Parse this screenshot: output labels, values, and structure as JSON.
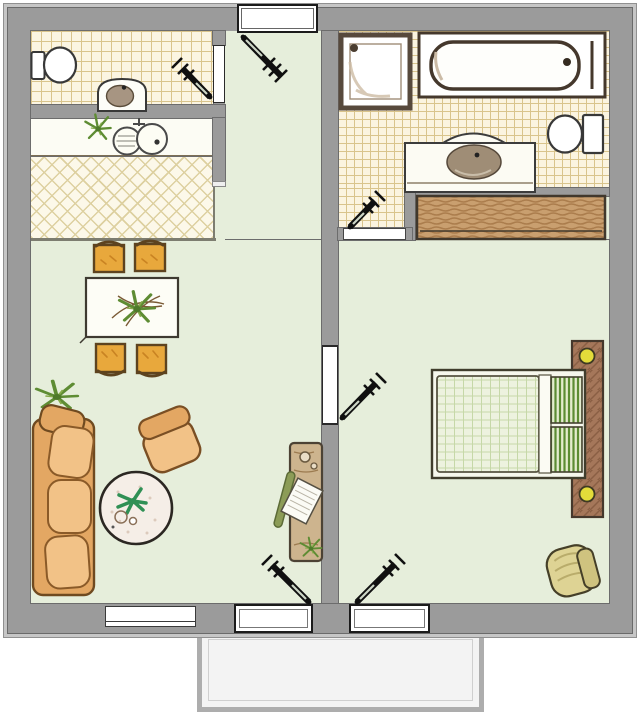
{
  "plan": {
    "type": "floor-plan",
    "style": "hand-drawn colored sketch, top-down view, no text labels",
    "rooms": [
      {
        "id": "wc",
        "name": "small-wc",
        "floor": "beige square tile grid",
        "fixtures": [
          "toilet",
          "washbasin"
        ]
      },
      {
        "id": "kitchen",
        "name": "kitchenette",
        "floor": "cream diagonal lattice tile",
        "fixtures": [
          "counter",
          "double-bowl sink",
          "potted plant"
        ]
      },
      {
        "id": "hallway",
        "name": "entrance-hall",
        "floor": "pale green",
        "fixtures": []
      },
      {
        "id": "living",
        "name": "living-dining-room",
        "floor": "pale green",
        "furniture": [
          "dining table with plant",
          "four orange chairs",
          "three-seat sofa",
          "armchair",
          "round rug with plant and cups",
          "floor plant",
          "desk with chair and papers"
        ]
      },
      {
        "id": "bathroom",
        "name": "bathroom",
        "floor": "cream square tile grid",
        "fixtures": [
          "shower tray",
          "bathtub",
          "toilet",
          "vanity washbasin"
        ]
      },
      {
        "id": "bedroom",
        "name": "bedroom",
        "floor": "pale green",
        "furniture": [
          "double bed with green striped pillows",
          "headboard console with two yellow lamps",
          "built-in wardrobe",
          "armchair"
        ]
      },
      {
        "id": "balcony",
        "name": "balcony",
        "floor": "white concrete"
      }
    ],
    "openings": {
      "doors": [
        {
          "id": "entrance",
          "location": "top wall into hallway"
        },
        {
          "id": "wc-door",
          "location": "hallway into wc"
        },
        {
          "id": "bathroom-door",
          "location": "bedroom lobby into bathroom"
        },
        {
          "id": "bedroom-door",
          "location": "living room into bedroom"
        },
        {
          "id": "living-balcony-door",
          "location": "living room bottom wall"
        },
        {
          "id": "bedroom-balcony-door",
          "location": "bedroom bottom wall"
        }
      ],
      "windows": [
        {
          "id": "living-window",
          "location": "living room bottom wall"
        }
      ]
    },
    "colors": {
      "wall": "#9b9b9b",
      "wall_outer_edge": "#c6c6c6",
      "floor_green": "#e6eedb",
      "tile_cream": "#fbf5e2",
      "tile_line": "#d9c48c",
      "counter_white": "#fcfcf4",
      "wood_wardrobe": "#c99f6f",
      "headboard_wood": "#a5775a",
      "sofa_tan": "#f2c287",
      "chair_orange": "#e8a83c",
      "pillow_green": "#5c8c33",
      "lamp_yellow": "#e3dc3a",
      "rug_white": "#f5eee7",
      "balcony": "#f3f3f3",
      "door_symbol": "#101010"
    }
  }
}
